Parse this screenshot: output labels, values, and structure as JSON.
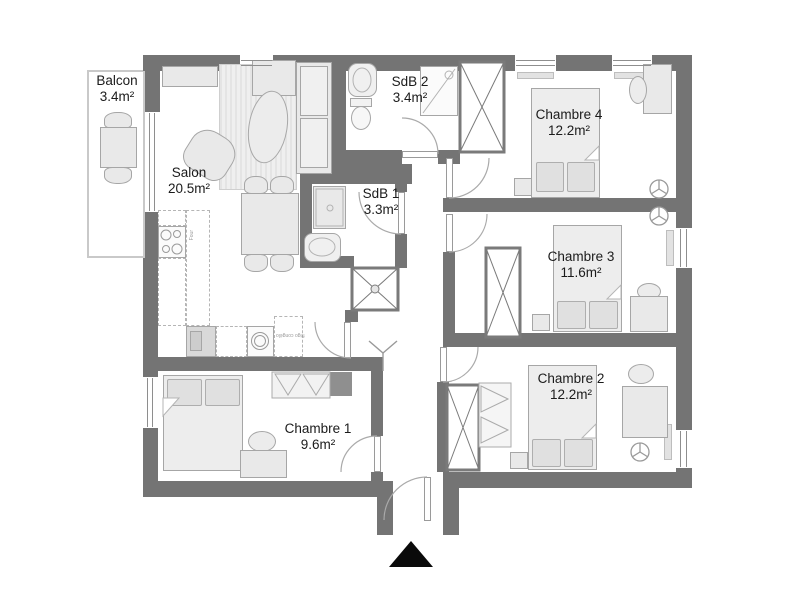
{
  "rooms": {
    "balcon": {
      "name": "Balcon",
      "area": "3.4m²"
    },
    "salon": {
      "name": "Salon",
      "area": "20.5m²"
    },
    "sdb2": {
      "name": "SdB 2",
      "area": "3.4m²"
    },
    "sdb1": {
      "name": "SdB 1",
      "area": "3.3m²"
    },
    "chambre4": {
      "name": "Chambre 4",
      "area": "12.2m²"
    },
    "chambre3": {
      "name": "Chambre 3",
      "area": "11.6m²"
    },
    "chambre2": {
      "name": "Chambre 2",
      "area": "12.2m²"
    },
    "chambre1": {
      "name": "Chambre 1",
      "area": "9.6m²"
    }
  },
  "kitchen": {
    "oven_label": "Four",
    "fridge_label": "frigo congélo"
  },
  "colors": {
    "wall": "#747474",
    "furniture_fill": "#e9e9e9",
    "furniture_border": "#a6a6a6",
    "entrance_marker": "#0a0a0a",
    "background": "#ffffff"
  }
}
